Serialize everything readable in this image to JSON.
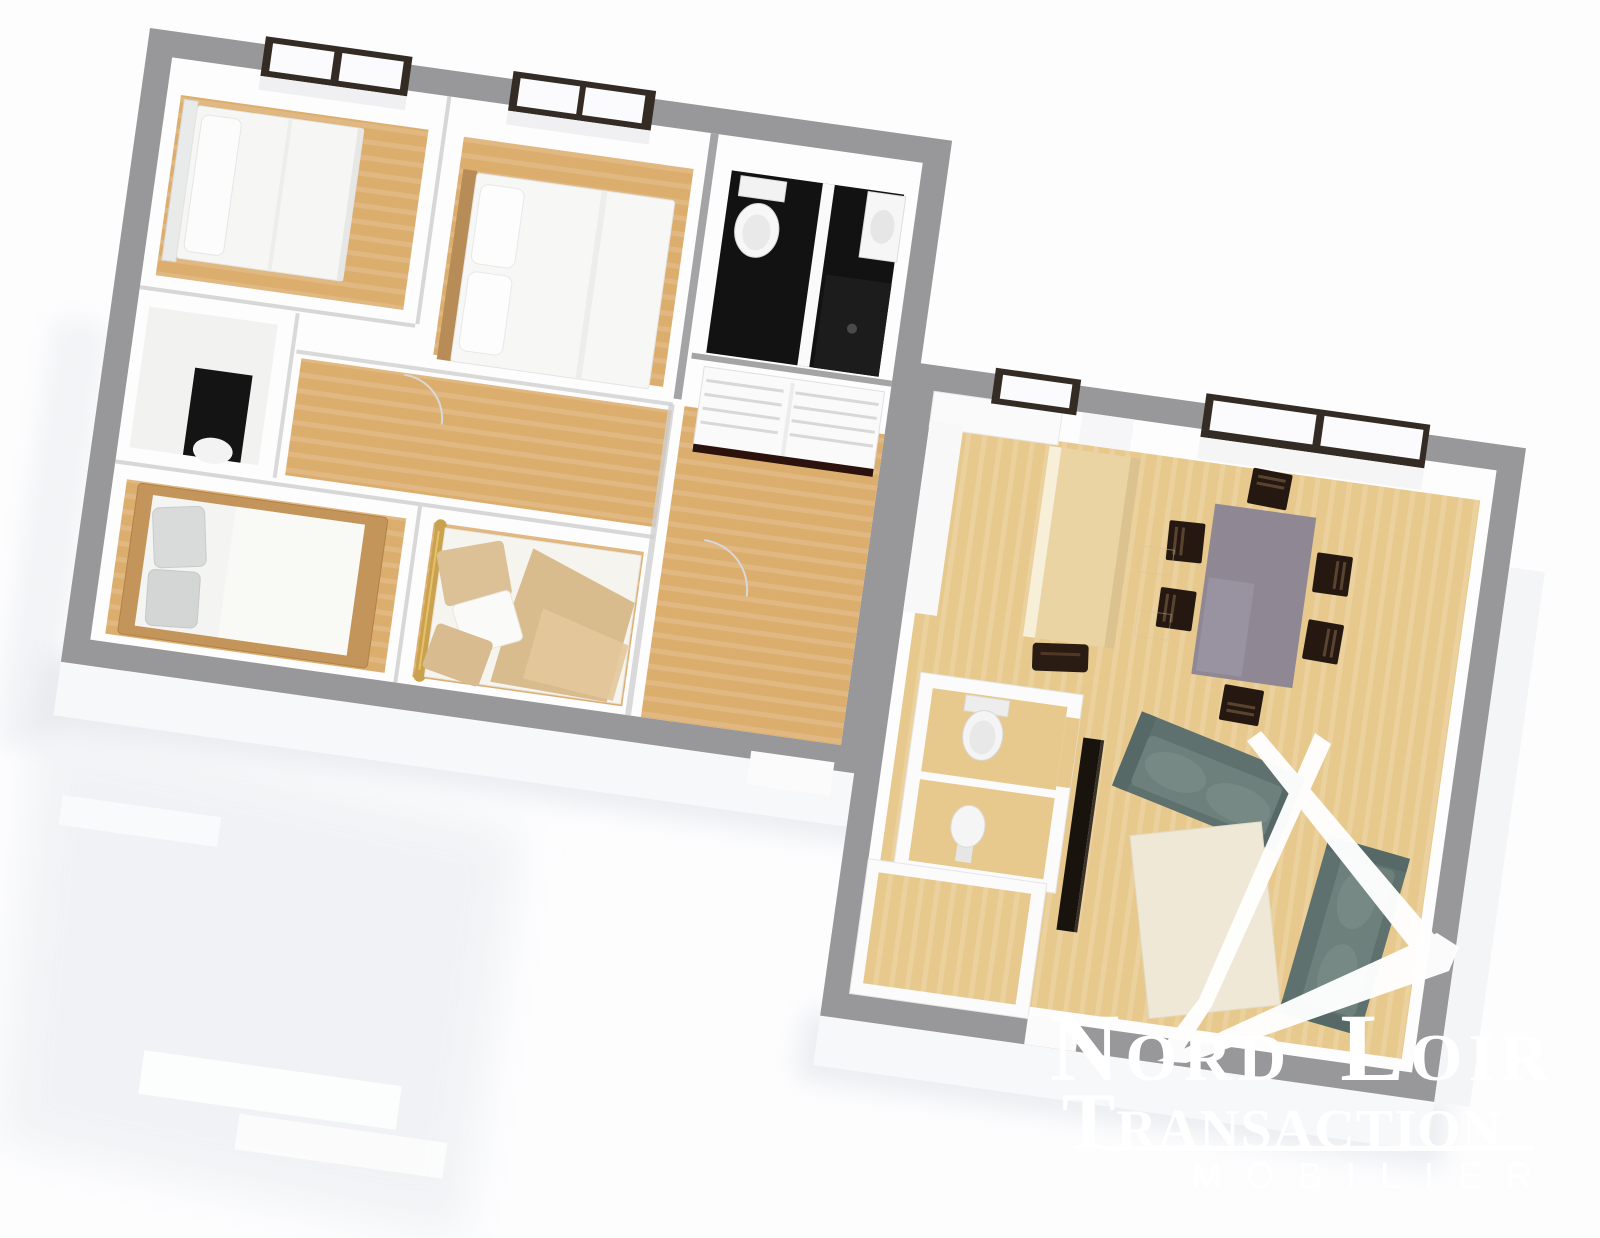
{
  "watermark": {
    "brand_line1": "Nord Loir",
    "brand_line2": "Transaction",
    "brand_line3": "MOBILIER"
  },
  "logo": {
    "icon": "brushstroke-letter-A-monogram",
    "color": "#ffffff"
  },
  "colors": {
    "wall": "#98989b",
    "interior": "#fdfdfd",
    "floor": "#dcae6e",
    "floor_light": "#ecd3a2",
    "floor_right": "#e8c98d",
    "floor_right_light": "#f4e3ba",
    "bath_floor": "#121212",
    "wood_bed": "#c4955a",
    "brass": "#caa24e",
    "blanket": "#d9bc8d",
    "sofa": "#5e716e",
    "sofa_seat": "#6d807c",
    "cushion": "#778985",
    "table": "#8f8894",
    "chair": "#241811",
    "cream": "#efe8d7",
    "window_frame": "#332b24",
    "facade": "#f7f8f9",
    "shadow": "#dde1e6",
    "text": "#ffffff"
  },
  "scene": {
    "type": "3d-floorplan-render",
    "rotation_degrees": 8,
    "buildings": [
      {
        "name": "upper-left-unit",
        "rooms": [
          {
            "name": "bedroom-top-left",
            "furniture": [
              "double-bed",
              "pillow",
              "window"
            ]
          },
          {
            "name": "bedroom-top-middle",
            "furniture": [
              "double-bed-wood-headboard",
              "pillows",
              "window"
            ]
          },
          {
            "name": "bathroom",
            "furniture": [
              "toilet",
              "washbasin",
              "shower",
              "black-tile-floor"
            ]
          },
          {
            "name": "slatted-dresser-alcove",
            "furniture": [
              "slatted-dresser"
            ]
          },
          {
            "name": "storage-closet",
            "furniture": [
              "dark-alcove",
              "fixture"
            ]
          },
          {
            "name": "hallway",
            "furniture": []
          },
          {
            "name": "bedroom-bottom-left",
            "furniture": [
              "wood-frame-bed",
              "gray-pillows"
            ]
          },
          {
            "name": "bedroom-bottom-middle",
            "furniture": [
              "brass-bed",
              "beige-blanket",
              "pillows"
            ]
          },
          {
            "name": "corridor",
            "furniture": []
          }
        ]
      },
      {
        "name": "lower-right-unit",
        "rooms": [
          {
            "name": "kitchen",
            "furniture": [
              "cupboard",
              "island-counter",
              "stool",
              "small-window"
            ]
          },
          {
            "name": "dining-area",
            "furniture": [
              "gray-dining-table",
              "six-dark-chairs",
              "large-double-window"
            ]
          },
          {
            "name": "living-area",
            "furniture": [
              "sofa-horizontal",
              "sofa-vertical",
              "cream-rug",
              "tv-panel"
            ]
          },
          {
            "name": "wc",
            "furniture": [
              "toilet",
              "washbasin"
            ]
          },
          {
            "name": "entry-room",
            "furniture": []
          }
        ]
      }
    ]
  }
}
